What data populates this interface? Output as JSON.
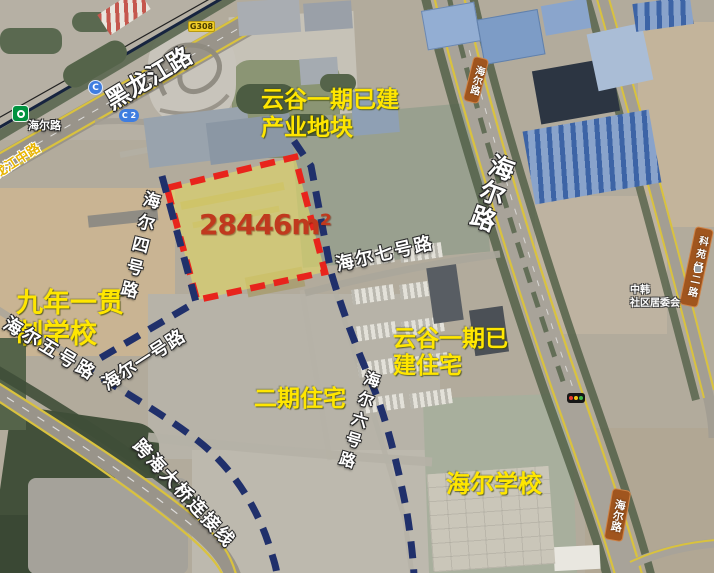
{
  "annotations": {
    "industrial_block": {
      "line1": "云谷一期已建",
      "line2": "产业地块"
    },
    "school9": {
      "line1": "九年一贯",
      "line2": "制学校"
    },
    "residential_built": {
      "line1": "云谷一期已",
      "line2": "建住宅"
    },
    "phase2_residential": "二期住宅",
    "haier_school": "海尔学校",
    "parcel_area": "28446m²"
  },
  "road_labels": {
    "heilongjiang": "黑龙江路",
    "longjiang_middle": "龙江中路",
    "haier_rd_topleft": "海尔路",
    "haier_rd_main": "海尔路",
    "haier_rd_shield_top": "海尔路",
    "haier_rd_shield_bottom": "海尔路",
    "keyuan_jing2": "科苑经二路",
    "haier_no1": "海尔一号路",
    "haier_no4": "海尔四号路",
    "haier_no5": "海尔五号路",
    "haier_no6": "海尔六号路",
    "haier_no7": "海尔七号路",
    "bridge_link": "跨海大桥连接线"
  },
  "badges": {
    "g308": "G308",
    "c": "C",
    "c2": "C 2"
  },
  "poi": {
    "community_line1": "中韩",
    "community_line2": "社区居委会"
  },
  "icons": {
    "traffic_light": "traffic-light",
    "metro_station": "metro-station"
  },
  "colors": {
    "annotation_yellow": "#ffe600",
    "parcel_border_red": "#e8241c",
    "boundary_navy": "#20306b",
    "area_text_red": "#c0391e",
    "parcel_fill_yellow": "#e3d964"
  }
}
